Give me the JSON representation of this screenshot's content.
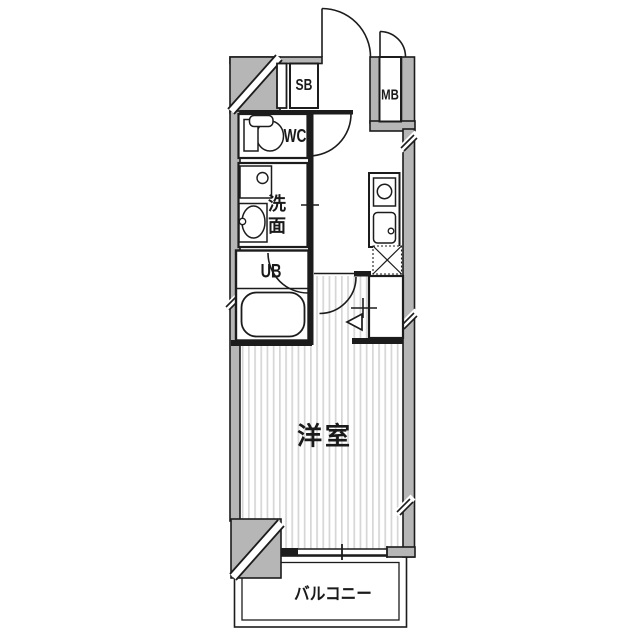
{
  "floor_plan": {
    "labels": {
      "shoe_box": "SB",
      "meter_box": "MB",
      "water_closet": "WC",
      "washroom": "洗面",
      "unit_bath": "UB",
      "western_room": "洋室",
      "balcony": "バルコニー"
    },
    "colors": {
      "wall_fill": "#b6b6b6",
      "line": "#1c1c1c",
      "floor_stripe": "#d6d6d6",
      "background": "#ffffff"
    }
  }
}
